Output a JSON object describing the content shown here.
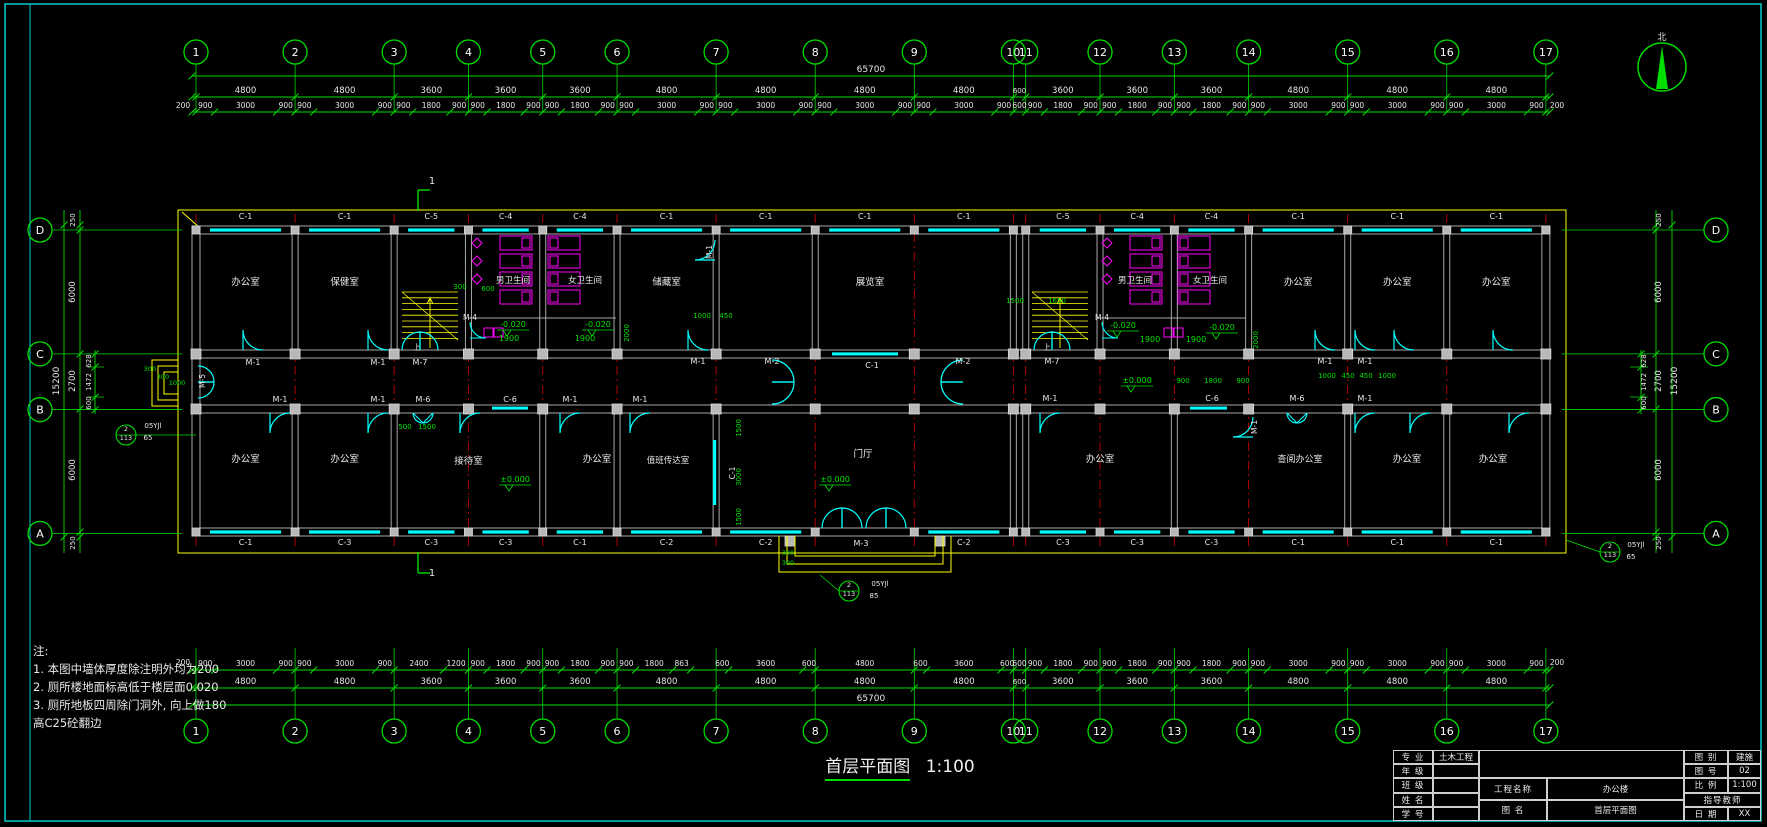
{
  "sheet": {
    "bg": "#000000",
    "frame_color": "#00cccc"
  },
  "compass": {
    "north_label": "北"
  },
  "drawing_title": {
    "text": "首层平面图",
    "scale": "1:100"
  },
  "notes": {
    "heading": "注:",
    "lines": [
      "1. 本图中墙体厚度除注明外均为200",
      "2. 厕所楼地面标高低于楼层面0.020",
      "3. 厕所地板四周除门洞外, 向上做180",
      "高C25砼翻边"
    ]
  },
  "axes": {
    "x_labels": [
      "1",
      "2",
      "3",
      "4",
      "5",
      "6",
      "7",
      "8",
      "9",
      "10",
      "11",
      "12",
      "13",
      "14",
      "15",
      "16",
      "17"
    ],
    "x_spans_mm": [
      4800,
      4800,
      3600,
      3600,
      3600,
      4800,
      4800,
      4800,
      4800,
      600,
      3600,
      3600,
      3600,
      4800,
      4800,
      4800
    ],
    "y_labels": [
      "D",
      "C",
      "B",
      "A"
    ],
    "y_spans_mm": [
      6000,
      2700,
      6000
    ],
    "x_total": "65700",
    "y_total": "15200",
    "x_end": "200",
    "y_end_top": "250",
    "y_end_bottom": "250"
  },
  "dims": {
    "top_detail": [
      [
        900,
        3000,
        900
      ],
      [
        900,
        3000,
        900
      ],
      [
        900,
        1800,
        900
      ],
      [
        900,
        1800,
        900
      ],
      [
        900,
        1800,
        900
      ],
      [
        900,
        3000,
        900
      ],
      [
        900,
        3000,
        900
      ],
      [
        900,
        3000,
        900
      ],
      [
        900,
        3000,
        900
      ],
      [
        600
      ],
      [
        900,
        1800,
        900
      ],
      [
        900,
        1800,
        900
      ],
      [
        900,
        1800,
        900
      ],
      [
        900,
        3000,
        900
      ],
      [
        900,
        3000,
        900
      ],
      [
        900,
        3000,
        900
      ]
    ],
    "bottom_detail": [
      [
        900,
        3000,
        900
      ],
      [
        900,
        3000,
        900
      ],
      [
        2400,
        1200
      ],
      [
        900,
        1800,
        900
      ],
      [
        900,
        1800,
        900
      ],
      [
        900,
        1800,
        863
      ],
      [
        600,
        3600,
        600
      ],
      [
        4800
      ],
      [
        600,
        3600,
        600
      ],
      [
        600
      ],
      [
        900,
        1800,
        900
      ],
      [
        900,
        1800,
        900
      ],
      [
        900,
        1800,
        900
      ],
      [
        900,
        3000,
        900
      ],
      [
        900,
        3000,
        900
      ],
      [
        900,
        3000,
        900
      ]
    ],
    "bottom_spans": [
      4800,
      4800,
      3600,
      3600,
      3600,
      4800,
      4800,
      4800,
      4800,
      600,
      3600,
      3600,
      3600,
      4800,
      4800,
      4800
    ],
    "left_subs": [
      "628",
      "1472",
      "600"
    ],
    "right_subs": [
      "628",
      "1472",
      "600"
    ]
  },
  "windows_top": [
    "C-1",
    "C-1",
    "C-5",
    "C-4",
    "C-4",
    "C-1",
    "C-1",
    "C-1",
    "C-1",
    "",
    "C-5",
    "C-4",
    "C-4",
    "C-1",
    "C-1",
    "C-1"
  ],
  "windows_bottom": [
    "C-1",
    "C-3",
    "C-3",
    "C-3",
    "C-1",
    "C-2",
    "C-2",
    "",
    "C-2",
    "",
    "C-3",
    "C-3",
    "C-3",
    "C-1",
    "C-1",
    "C-1"
  ],
  "rooms_top": [
    {
      "name": "办公室",
      "a": 0,
      "b": 1
    },
    {
      "name": "保健室",
      "a": 1,
      "b": 2
    },
    {
      "name": "男卫生间",
      "a": 3,
      "b": 4,
      "lx": 513,
      "ly": 283,
      "s": 8.5
    },
    {
      "name": "女卫生间",
      "a": 4,
      "b": 5,
      "lx": 585,
      "ly": 283,
      "s": 8.5
    },
    {
      "name": "储藏室",
      "a": 5,
      "b": 6
    },
    {
      "name": "展览室",
      "a": 7,
      "b": 9,
      "lx": 870
    },
    {
      "name": "男卫生间",
      "a": 11,
      "b": 12,
      "lx": 1135,
      "ly": 283,
      "s": 8.5
    },
    {
      "name": "女卫生间",
      "a": 12,
      "b": 13,
      "lx": 1210,
      "ly": 283,
      "s": 8.5
    },
    {
      "name": "办公室",
      "a": 13,
      "b": 14
    },
    {
      "name": "办公室",
      "a": 14,
      "b": 15
    },
    {
      "name": "办公室",
      "a": 15,
      "b": 16
    }
  ],
  "rooms_bottom": [
    {
      "name": "办公室",
      "a": 0,
      "b": 1
    },
    {
      "name": "办公室",
      "a": 1,
      "b": 2
    },
    {
      "name": "接待室",
      "a": 2,
      "b": 4,
      "ly": 464
    },
    {
      "name": "办公室",
      "a": 4,
      "b": 5,
      "lx": 597
    },
    {
      "name": "值班传达室",
      "a": 5,
      "b": 6,
      "lx": 668,
      "ly": 463,
      "s": 8.5
    },
    {
      "name": "门厅",
      "a": 6,
      "b": 9,
      "lx": 863,
      "ly": 457
    },
    {
      "name": "办公室",
      "a": 10,
      "b": 12,
      "lx": 1100
    },
    {
      "name": "查阅办公室",
      "a": 12,
      "b": 14,
      "lx": 1300,
      "s": 9
    },
    {
      "name": "办公室",
      "a": 14,
      "b": 15,
      "lx": 1407
    },
    {
      "name": "办公室",
      "a": 15,
      "b": 16,
      "lx": 1493
    }
  ],
  "annotations": [
    {
      "t": "M-1",
      "x": 253,
      "y": 365,
      "c": "w"
    },
    {
      "t": "M-1",
      "x": 378,
      "y": 365,
      "c": "w"
    },
    {
      "t": "M-7",
      "x": 420,
      "y": 365,
      "c": "w"
    },
    {
      "t": "M-1",
      "x": 698,
      "y": 364,
      "c": "w"
    },
    {
      "t": "M-2",
      "x": 772,
      "y": 364,
      "c": "w"
    },
    {
      "t": "C-1",
      "x": 872,
      "y": 368,
      "c": "w"
    },
    {
      "t": "M-2",
      "x": 963,
      "y": 364,
      "c": "w"
    },
    {
      "t": "M-7",
      "x": 1052,
      "y": 364,
      "c": "w"
    },
    {
      "t": "M-1",
      "x": 1325,
      "y": 364,
      "c": "w"
    },
    {
      "t": "M-1",
      "x": 1365,
      "y": 364,
      "c": "w"
    },
    {
      "t": "M-1",
      "x": 280,
      "y": 402,
      "c": "w"
    },
    {
      "t": "M-1",
      "x": 378,
      "y": 402,
      "c": "w"
    },
    {
      "t": "M-6",
      "x": 423,
      "y": 402,
      "c": "w"
    },
    {
      "t": "C-6",
      "x": 510,
      "y": 402,
      "c": "w"
    },
    {
      "t": "M-1",
      "x": 570,
      "y": 402,
      "c": "w"
    },
    {
      "t": "M-1",
      "x": 640,
      "y": 402,
      "c": "w"
    },
    {
      "t": "M-1",
      "x": 1050,
      "y": 401,
      "c": "w"
    },
    {
      "t": "C-6",
      "x": 1212,
      "y": 401,
      "c": "w"
    },
    {
      "t": "M-6",
      "x": 1297,
      "y": 401,
      "c": "w"
    },
    {
      "t": "M-1",
      "x": 1365,
      "y": 401,
      "c": "w"
    },
    {
      "t": "M-4",
      "x": 470,
      "y": 320,
      "c": "w",
      "s": 7.5
    },
    {
      "t": "M-4",
      "x": 1102,
      "y": 320,
      "c": "w",
      "s": 7.5
    },
    {
      "t": "M-5",
      "x": 205,
      "y": 381,
      "c": "w",
      "r": -90,
      "s": 7.5
    },
    {
      "t": "M-1",
      "x": 712,
      "y": 252,
      "c": "w",
      "r": -90,
      "s": 7.5
    },
    {
      "t": "C-1",
      "x": 735,
      "y": 473,
      "c": "w",
      "r": -90,
      "s": 7.5
    },
    {
      "t": "M-1",
      "x": 1257,
      "y": 427,
      "c": "w",
      "r": -90,
      "s": 7.5
    },
    {
      "t": "M-3",
      "x": 861,
      "y": 546,
      "c": "w"
    },
    {
      "t": "上",
      "x": 417,
      "y": 350,
      "c": "w",
      "s": 8
    },
    {
      "t": "上",
      "x": 1047,
      "y": 350,
      "c": "w",
      "s": 8
    },
    {
      "t": "1",
      "x": 432,
      "y": 184,
      "c": "w",
      "s": 10
    },
    {
      "t": "1",
      "x": 432,
      "y": 576,
      "c": "w",
      "s": 10
    },
    {
      "t": "05YJl",
      "x": 153,
      "y": 428,
      "c": "w",
      "s": 7
    },
    {
      "t": "65",
      "x": 148,
      "y": 440,
      "c": "w",
      "s": 7
    },
    {
      "t": "2",
      "x": 126,
      "y": 431,
      "c": "w",
      "s": 6.5
    },
    {
      "t": "113",
      "x": 126,
      "y": 440,
      "c": "w",
      "s": 6.5
    },
    {
      "t": "05YJl",
      "x": 1636,
      "y": 547,
      "c": "w",
      "s": 7
    },
    {
      "t": "65",
      "x": 1631,
      "y": 559,
      "c": "w",
      "s": 7
    },
    {
      "t": "2",
      "x": 1610,
      "y": 548,
      "c": "w",
      "s": 6.5
    },
    {
      "t": "113",
      "x": 1610,
      "y": 557,
      "c": "w",
      "s": 6.5
    },
    {
      "t": "05YJl",
      "x": 880,
      "y": 586,
      "c": "w",
      "s": 7
    },
    {
      "t": "85",
      "x": 874,
      "y": 598,
      "c": "w",
      "s": 7
    },
    {
      "t": "2",
      "x": 849,
      "y": 587,
      "c": "w",
      "s": 6.5
    },
    {
      "t": "113",
      "x": 849,
      "y": 596,
      "c": "w",
      "s": 6.5
    },
    {
      "t": "1900",
      "x": 509,
      "y": 341
    },
    {
      "t": "1900",
      "x": 585,
      "y": 341
    },
    {
      "t": "1900",
      "x": 1150,
      "y": 342
    },
    {
      "t": "1900",
      "x": 1196,
      "y": 342
    },
    {
      "t": "-0.020",
      "x": 513,
      "y": 327,
      "lvl": 1
    },
    {
      "t": "-0.020",
      "x": 598,
      "y": 327,
      "lvl": 1
    },
    {
      "t": "-0.020",
      "x": 1123,
      "y": 328,
      "lvl": 1
    },
    {
      "t": "-0.020",
      "x": 1222,
      "y": 330,
      "lvl": 1
    },
    {
      "t": "±0.000",
      "x": 515,
      "y": 482,
      "lvl": 1
    },
    {
      "t": "±0.000",
      "x": 835,
      "y": 482,
      "lvl": 1
    },
    {
      "t": "±0.000",
      "x": 1137,
      "y": 383,
      "lvl": 1
    },
    {
      "t": "300",
      "x": 460,
      "y": 289,
      "s": 7
    },
    {
      "t": "600",
      "x": 488,
      "y": 291,
      "s": 7
    },
    {
      "t": "1500",
      "x": 1015,
      "y": 303,
      "s": 7
    },
    {
      "t": "1650",
      "x": 1057,
      "y": 303,
      "s": 7
    },
    {
      "t": "2000",
      "x": 629,
      "y": 333,
      "r": -90,
      "s": 7
    },
    {
      "t": "2000",
      "x": 1258,
      "y": 340,
      "r": -90,
      "s": 7
    },
    {
      "t": "1000",
      "x": 702,
      "y": 318,
      "s": 7
    },
    {
      "t": "450",
      "x": 726,
      "y": 318,
      "s": 7
    },
    {
      "t": "500",
      "x": 405,
      "y": 429,
      "s": 7
    },
    {
      "t": "1500",
      "x": 427,
      "y": 429,
      "s": 7
    },
    {
      "t": "900",
      "x": 1183,
      "y": 383,
      "s": 7
    },
    {
      "t": "1800",
      "x": 1213,
      "y": 383,
      "s": 7
    },
    {
      "t": "900",
      "x": 1243,
      "y": 383,
      "s": 7
    },
    {
      "t": "1000",
      "x": 1327,
      "y": 378,
      "s": 7
    },
    {
      "t": "450",
      "x": 1348,
      "y": 378,
      "s": 7
    },
    {
      "t": "450",
      "x": 1366,
      "y": 378,
      "s": 7
    },
    {
      "t": "1000",
      "x": 1387,
      "y": 378,
      "s": 7
    },
    {
      "t": "1500",
      "x": 741,
      "y": 428,
      "r": -90,
      "s": 7
    },
    {
      "t": "3000",
      "x": 741,
      "y": 477,
      "r": -90,
      "s": 7
    },
    {
      "t": "1500",
      "x": 741,
      "y": 517,
      "r": -90,
      "s": 7
    },
    {
      "t": "300",
      "x": 150,
      "y": 371,
      "s": 6.5
    },
    {
      "t": "300",
      "x": 163,
      "y": 379,
      "s": 6.5
    },
    {
      "t": "1000",
      "x": 177,
      "y": 385,
      "s": 6.5
    },
    {
      "t": "300",
      "x": 788,
      "y": 555,
      "s": 6.5
    },
    {
      "t": "300",
      "x": 788,
      "y": 565,
      "s": 6.5
    }
  ],
  "titleblock": {
    "rows_left": [
      [
        "专 业",
        "土木工程"
      ],
      [
        "年 级",
        ""
      ],
      [
        "班 级",
        ""
      ],
      [
        "姓 名",
        ""
      ],
      [
        "学 号",
        ""
      ]
    ],
    "project_label": "工程名称",
    "project_value": "办公楼",
    "drawing_label": "图 名",
    "drawing_value": "首层平面图",
    "rows_right": [
      [
        "图 别",
        "建施"
      ],
      [
        "图 号",
        "02"
      ],
      [
        "比 例",
        "1:100"
      ],
      [
        "指导教师",
        ""
      ],
      [
        "日 期",
        "XX"
      ]
    ]
  }
}
